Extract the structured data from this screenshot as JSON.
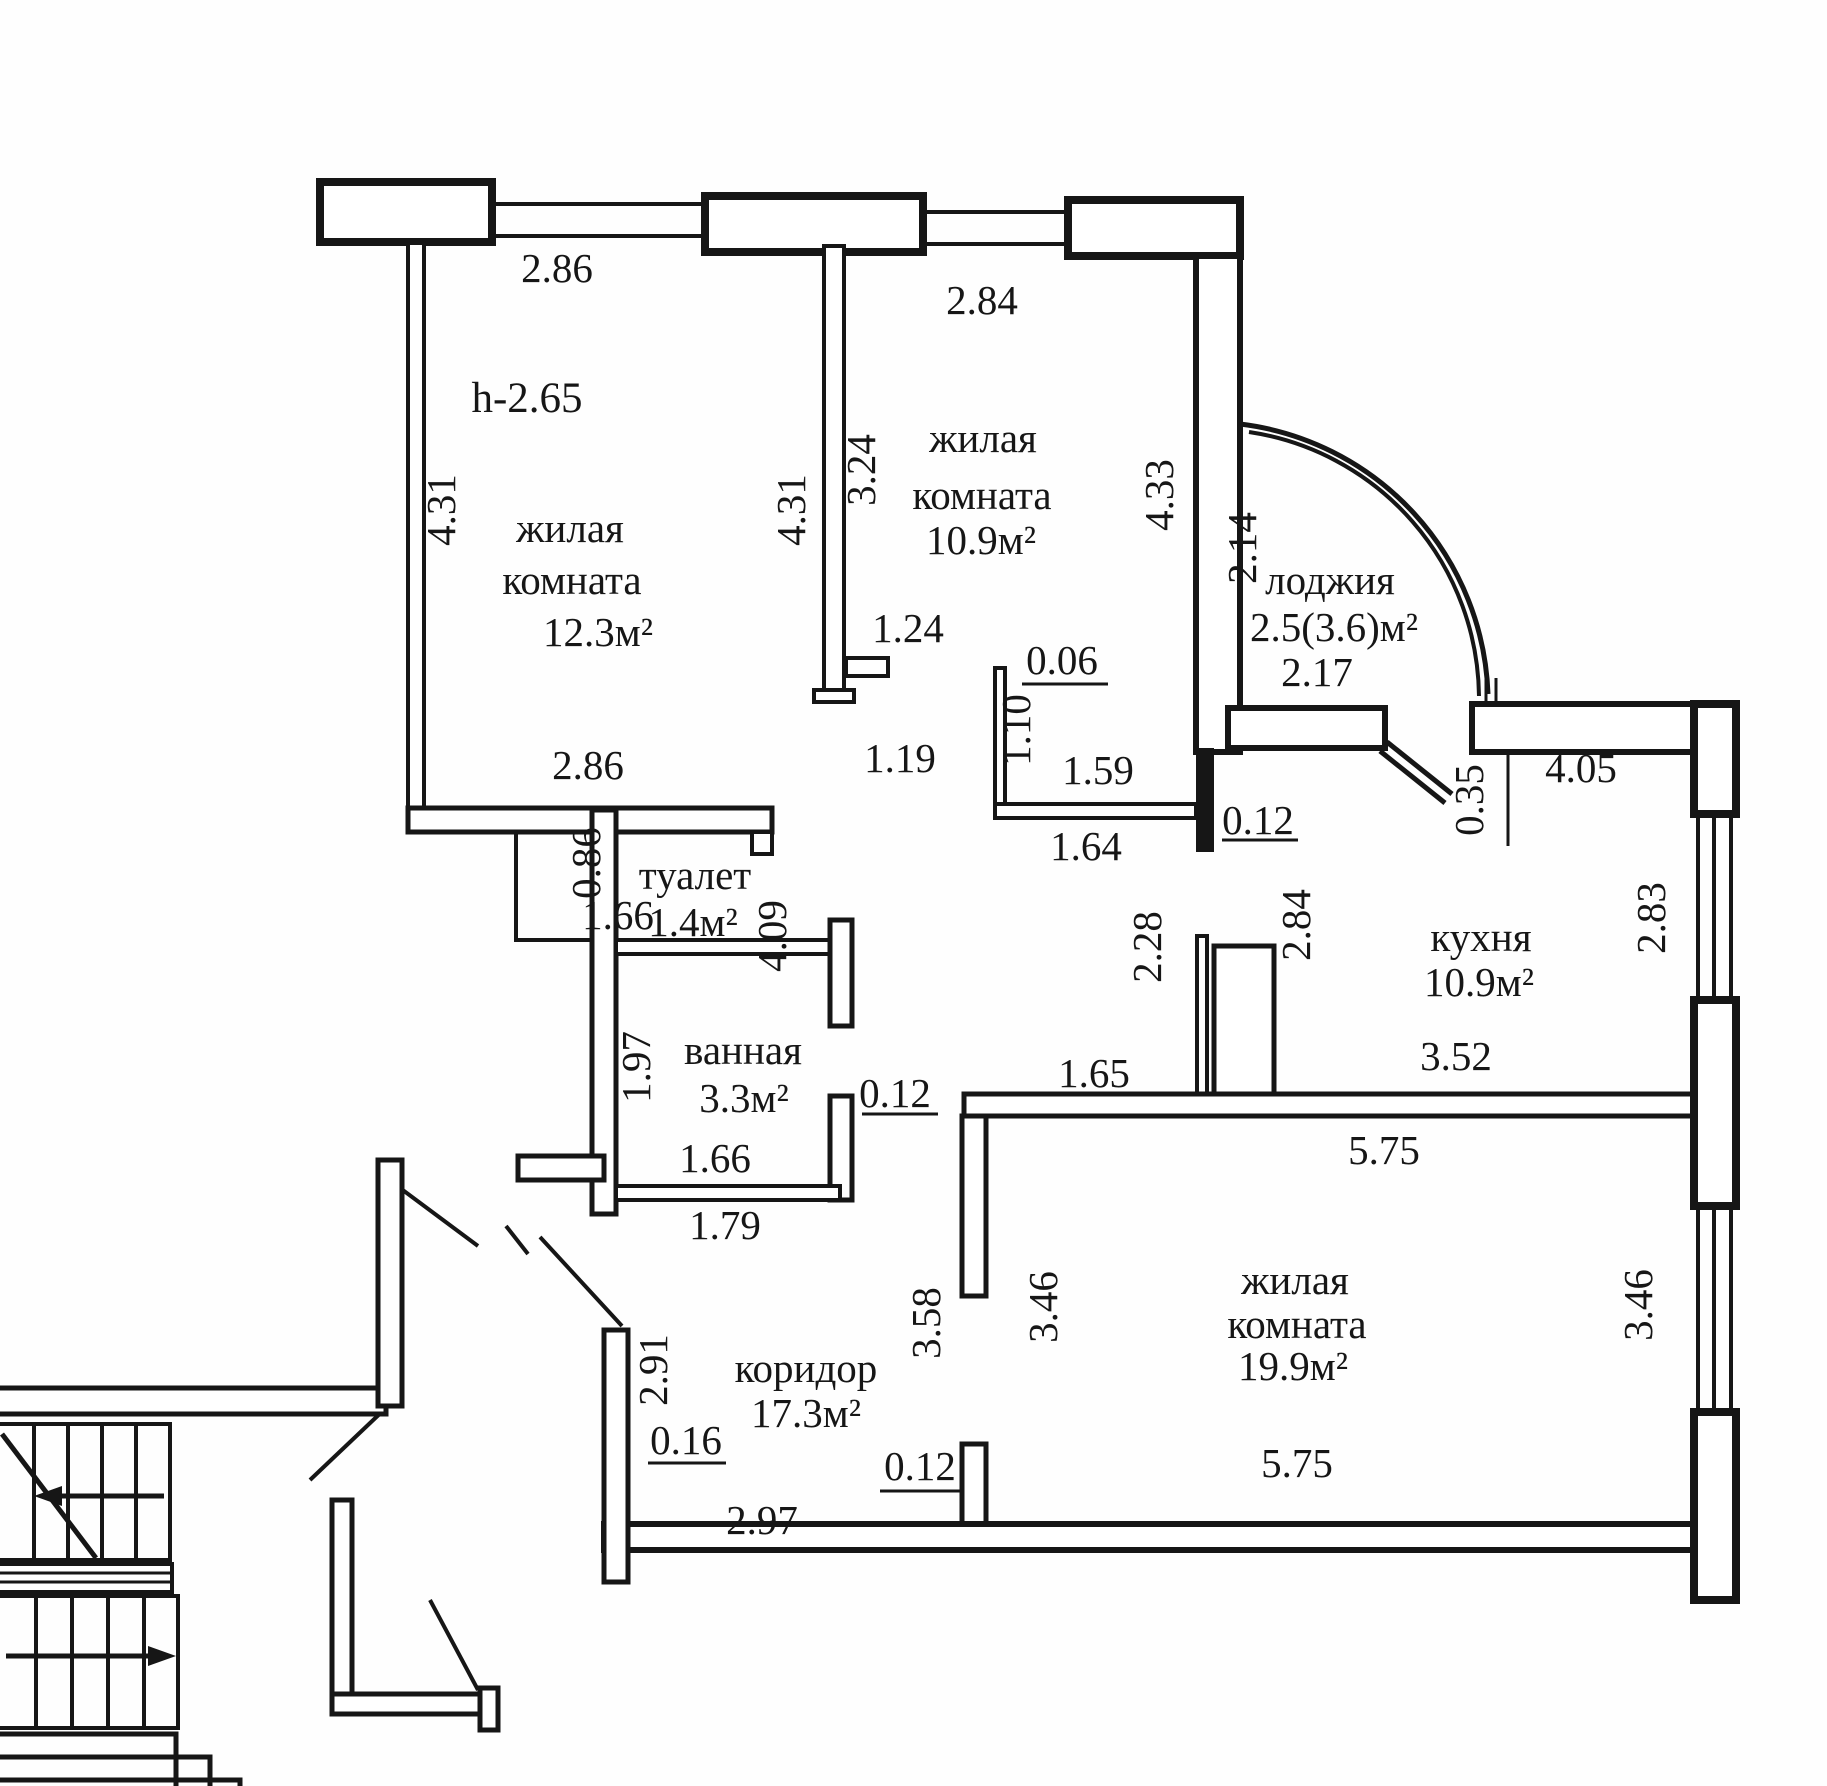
{
  "plan": {
    "ceiling_height": "h-2.65",
    "rooms": {
      "living_1": {
        "line1": "жилая",
        "line2": "комната",
        "area": "12.3м²"
      },
      "living_2": {
        "line1": "жилая",
        "line2": "комната",
        "area": "10.9м²"
      },
      "living_3": {
        "line1": "жилая",
        "line2": "комната",
        "area": "19.9м²"
      },
      "kitchen": {
        "name": "кухня",
        "area": "10.9м²"
      },
      "loggia": {
        "name": "лоджия",
        "area": "2.5(3.6)м²",
        "width": "2.17"
      },
      "toilet": {
        "name": "туалет",
        "area": "1.4м²"
      },
      "bathroom": {
        "name": "ванная",
        "area": "3.3м²"
      },
      "corridor": {
        "name": "коридор",
        "area": "17.3м²"
      }
    },
    "dimensions": {
      "top_window_1": "2.86",
      "top_window_2": "2.84",
      "living1_left": "4.31",
      "living1_right": "4.31",
      "living2_left": "3.24",
      "living2_right": "4.33",
      "living1_bottom": "2.86",
      "loggia_side": "2.14",
      "partition_124": "1.24",
      "door_119": "1.19",
      "nook_006": "0.06",
      "nook_110": "1.10",
      "nook_159": "1.59",
      "nook_164": "1.64",
      "nook_012": "0.12",
      "kitchen_035": "0.35",
      "kitchen_405": "4.05",
      "kitchen_283": "2.83",
      "kitchen_352": "3.52",
      "kitchen_165": "1.65",
      "kitchen_228": "2.28",
      "kitchen_284": "2.84",
      "toilet_086": "0.86",
      "toilet_166": "1.66",
      "toilet_409": "4.09",
      "bath_197": "1.97",
      "bath_166": "1.66",
      "bath_012": "0.12",
      "bath_179": "1.79",
      "corridor_291": "2.91",
      "corridor_016": "0.16",
      "corridor_358": "3.58",
      "corridor_012": "0.12",
      "corridor_297": "2.97",
      "living3_top": "5.75",
      "living3_bottom": "5.75",
      "living3_left": "3.46",
      "living3_right": "3.46"
    }
  }
}
